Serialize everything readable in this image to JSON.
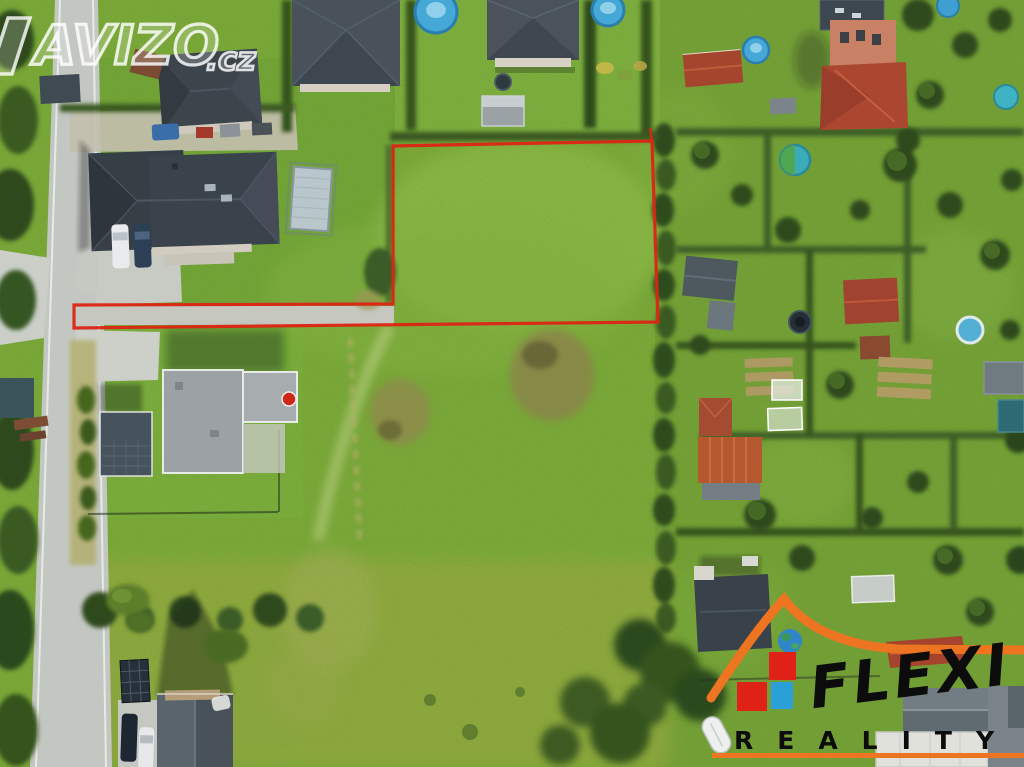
{
  "watermark": {
    "brand": "AVIZO",
    "tld": ".cz",
    "color": "#ffffff"
  },
  "agency_logo": {
    "name": "FLEXI",
    "subtitle": "REALITY",
    "colors": {
      "orange": "#ed7420",
      "red": "#df2118",
      "blue": "#2ba0d8",
      "text": "#0c0c0c"
    }
  },
  "overlay": {
    "plot_outline_color": "#dd2414",
    "plot_outline_points": "393,304 393,146 652,141 658,322 74,328 74,305",
    "plot_tick_points": "652,141 650,128"
  },
  "scene_palette": {
    "grass": "#7cab39",
    "meadow_light": "#8cbb44",
    "dry_grass": "#a9b55f",
    "road_gray": "#c3c7c2",
    "roof_dark_slate": "#3a424b",
    "roof_terracotta": "#a84531",
    "pool_blue": "#46a8d6",
    "hedge_dark": "#2f4c1d"
  }
}
